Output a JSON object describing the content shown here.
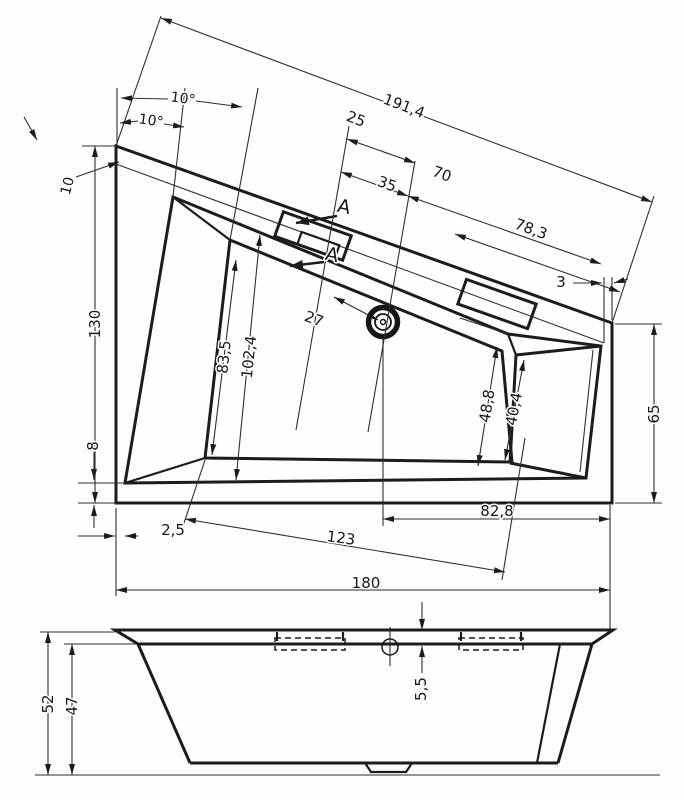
{
  "drawing": {
    "description": "Technical dimension drawing of an asymmetric corner bathtub: plan view (top) and side elevation (bottom)",
    "units": "cm"
  },
  "top_view": {
    "angle_upper": "10°",
    "angle_lower": "10°",
    "rim_width": "10",
    "edge_length": "191,4",
    "d25": "25",
    "d35": "35",
    "d70": "70",
    "d78_3": "78,3",
    "d3": "3",
    "depth": "130",
    "d27": "27",
    "d83_5": "83,5",
    "d102_4": "102,4",
    "d48_8": "48,8",
    "d40_4": "40,4",
    "right_depth": "65",
    "d8": "8",
    "d2_5": "2,5",
    "d123": "123",
    "d82_8": "82,8",
    "width": "180",
    "section_a_top": "A",
    "section_a_bottom": "A"
  },
  "side_view": {
    "height_total": "52",
    "height_inner": "47",
    "rim_thickness": "5,5"
  }
}
